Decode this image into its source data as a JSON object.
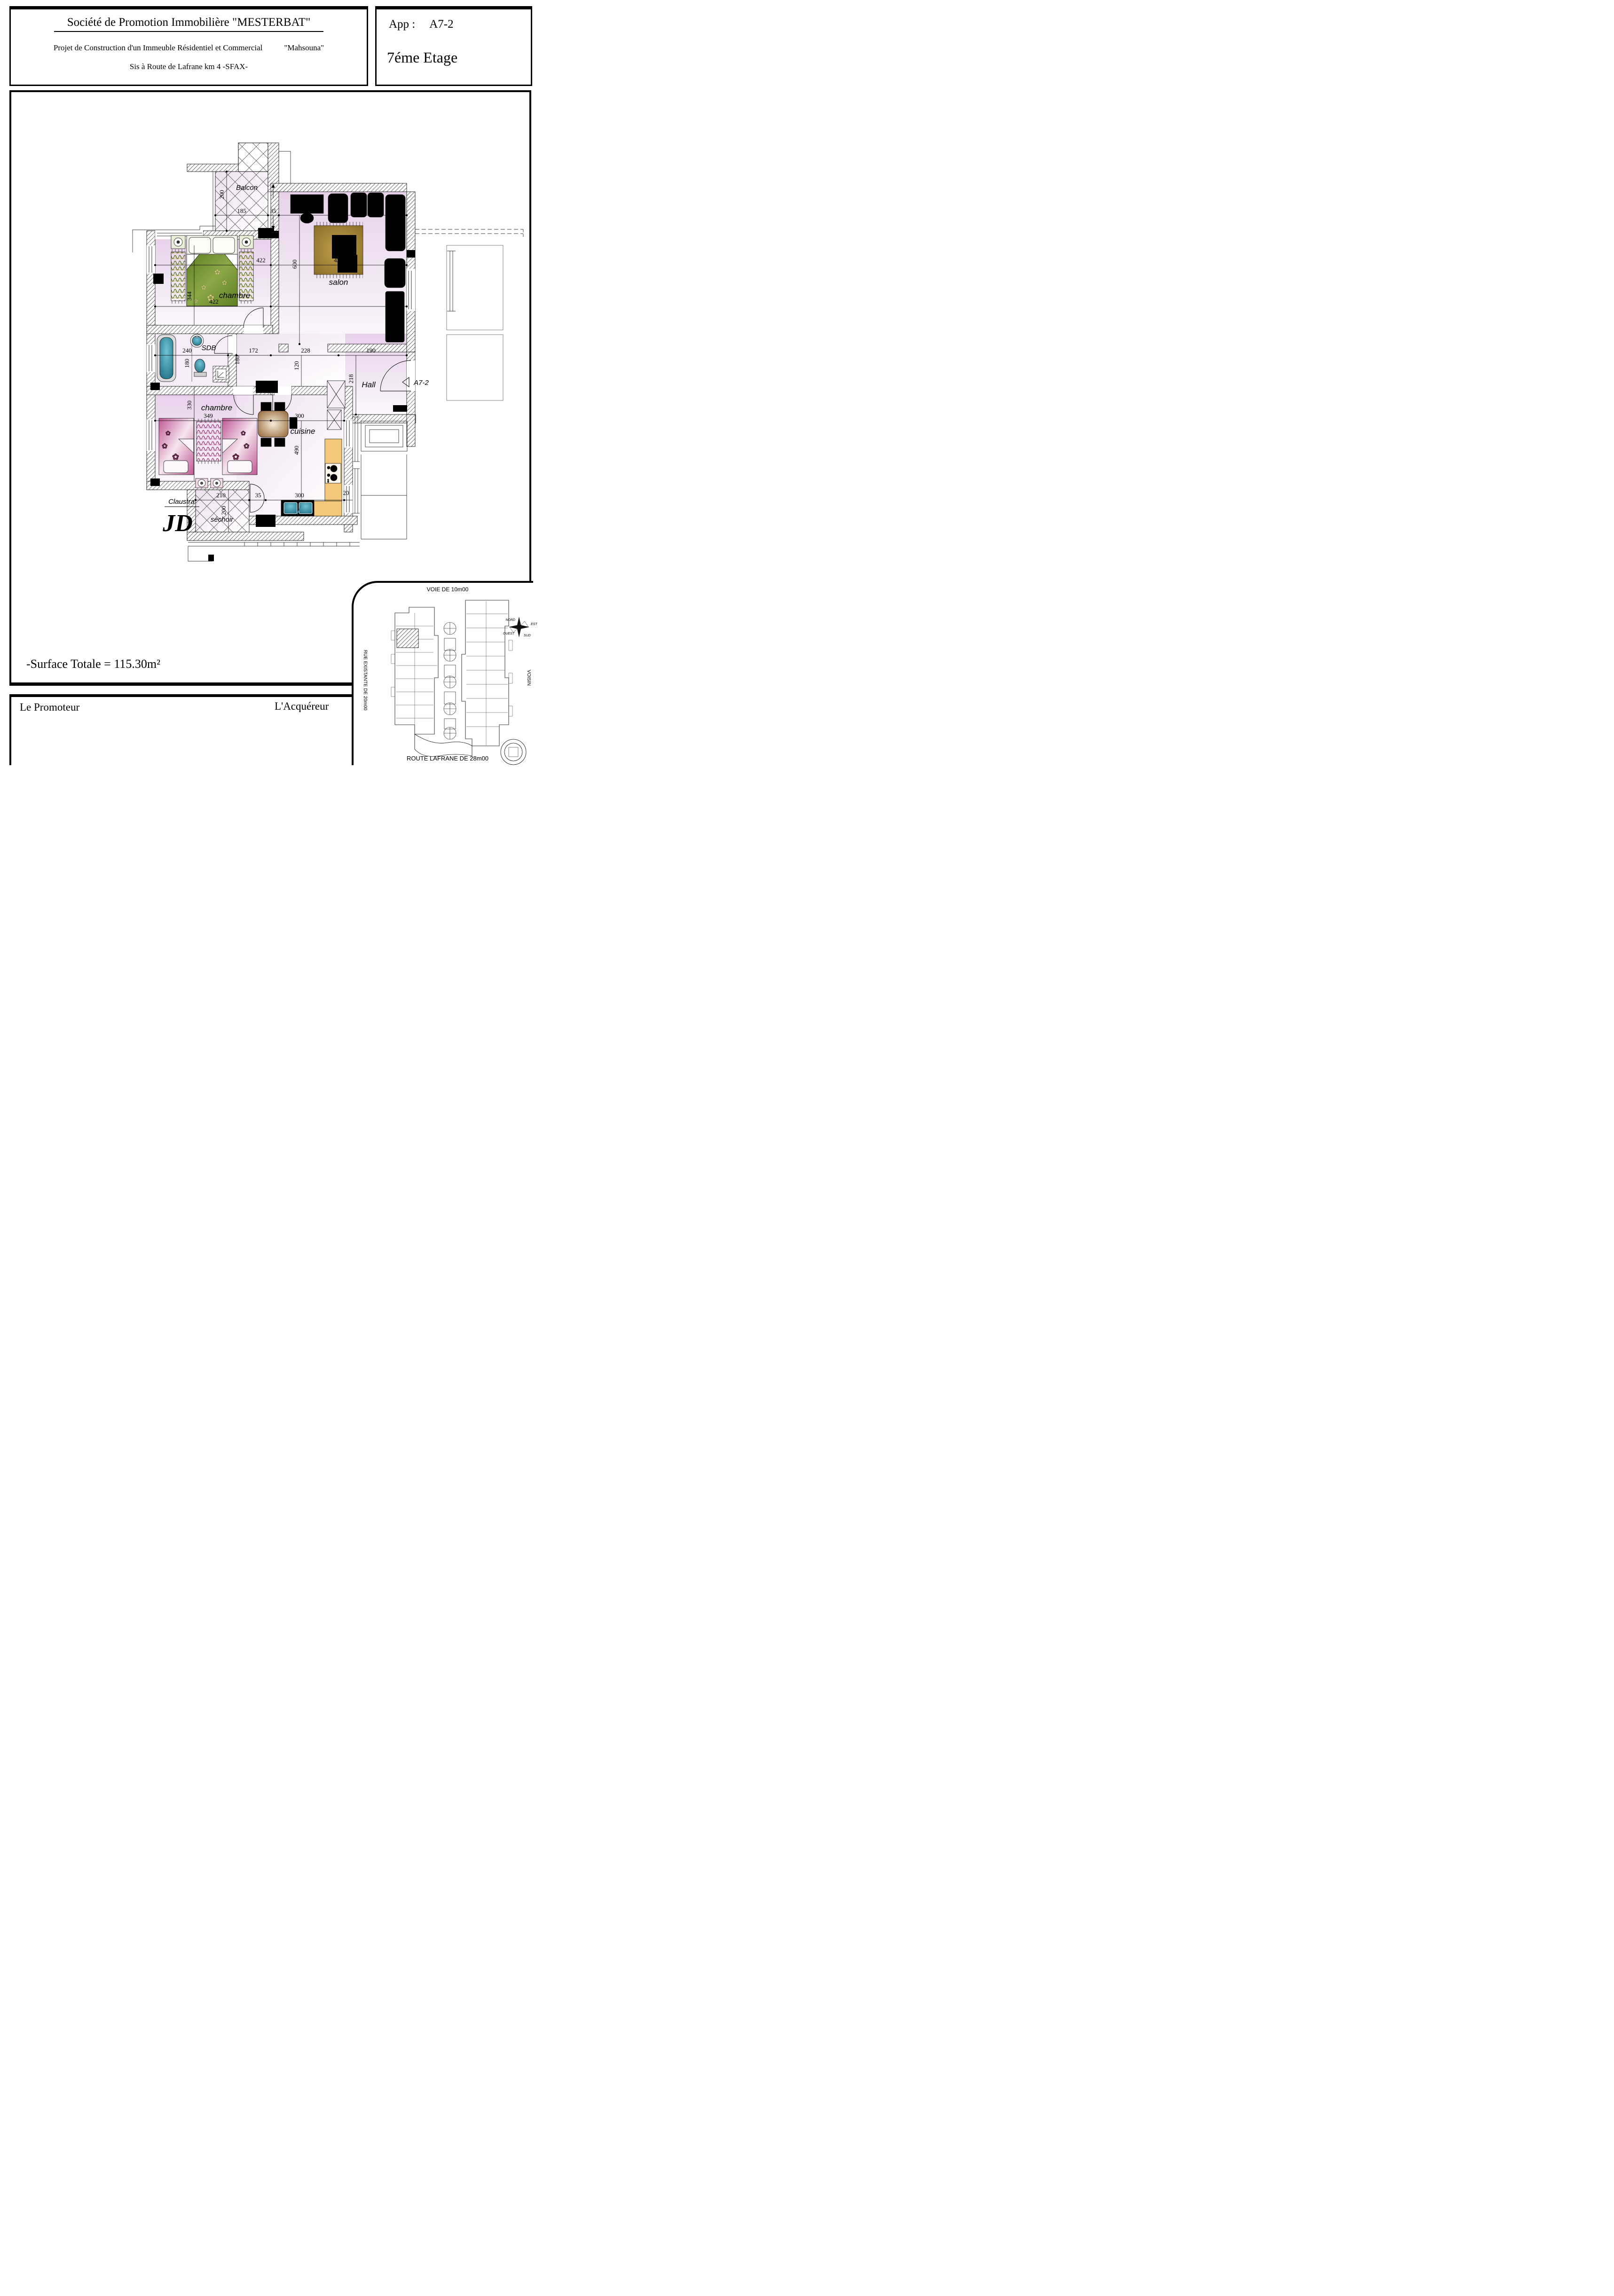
{
  "header": {
    "company": "Société de Promotion Immobilière \"MESTERBAT\"",
    "project": "Projet de Construction d'un Immeuble Résidentiel et Commercial",
    "project_name": "\"Mahsouna\"",
    "address": "Sis à Route de Lafrane km 4  -SFAX-",
    "app_label": "App :",
    "app_value": "A7-2",
    "floor": "7éme Etage"
  },
  "plan": {
    "rooms": {
      "balcon": "Balcon",
      "chambre1": "chambre",
      "salon": "salon",
      "sdb": "SDB",
      "hall": "Hall",
      "chambre2": "chambre",
      "cuisine": "cuisine",
      "sechoir": "séchoir",
      "claustra": "Claustra",
      "signature": "JD",
      "entrance": "A7-2"
    },
    "dims": {
      "balcon_depth": "200",
      "balcon_width": "185",
      "wall_top": "35",
      "salon_width": "430",
      "chambre1_width": "422",
      "rug_width": "430",
      "salon_depth": "600",
      "chambre1_depth": "344",
      "chambre1_width2": "422",
      "sdb_width": "240",
      "sdb_depth": "180",
      "corridor_depth": "180",
      "corridor_172": "172",
      "corridor_228": "228",
      "hall_width": "190",
      "corridor_120": "120",
      "hall_depth": "218",
      "chambre2_depth": "330",
      "chambre2_width": "349",
      "cuisine_width": "300",
      "cuisine_depth": "490",
      "counter": "20",
      "sechoir_width": "210",
      "wall_bottom": "35",
      "cuisine_width2": "300",
      "sechoir_depth": "200"
    }
  },
  "summary": {
    "surface_total": "-Surface Totale = 115.30m²"
  },
  "footer": {
    "promoter": "Le Promoteur",
    "acquirer": "L'Acquéreur"
  },
  "siteplan": {
    "road_top": "VOIE DE 10m00",
    "road_left": "RUE  EXISTANTE  DE  20m00",
    "neighbor_right": "VOISIN",
    "road_bottom": "ROUTE LAFRANE   DE   28m00",
    "compass": {
      "north": "NORD",
      "east": "EST",
      "south": "SUD",
      "west": "OUEST"
    }
  },
  "colors": {
    "wall": "#000000",
    "floor_pink": "#eedff0",
    "bed_green": "#7d9c39",
    "bed_pink": "#c05794",
    "rug_brown": "#9b7c33",
    "fixture_teal": "#2e8099",
    "counter_orange": "#f4c87a"
  }
}
